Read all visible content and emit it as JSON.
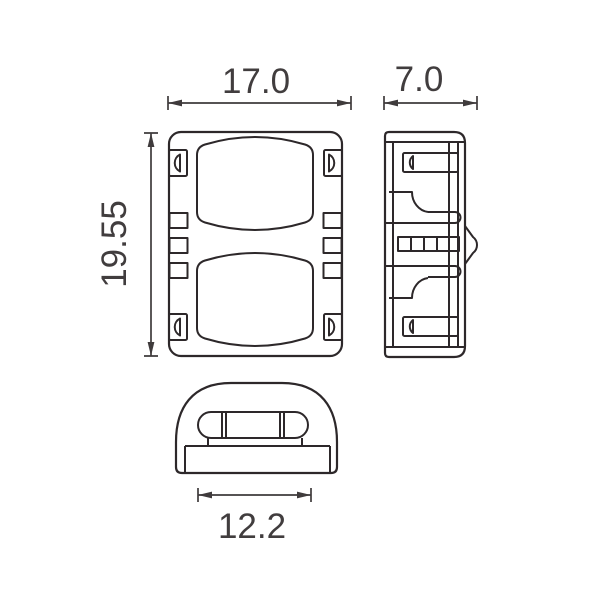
{
  "drawing": {
    "kind": "technical-drawing-three-views",
    "dimensions": {
      "front_width": "17.0",
      "front_height": "19.55",
      "side_width": "7.0",
      "bottom_width": "12.2"
    }
  },
  "colors": {
    "background": "#ffffff",
    "line": "#2d282a",
    "text": "#413d3e"
  }
}
